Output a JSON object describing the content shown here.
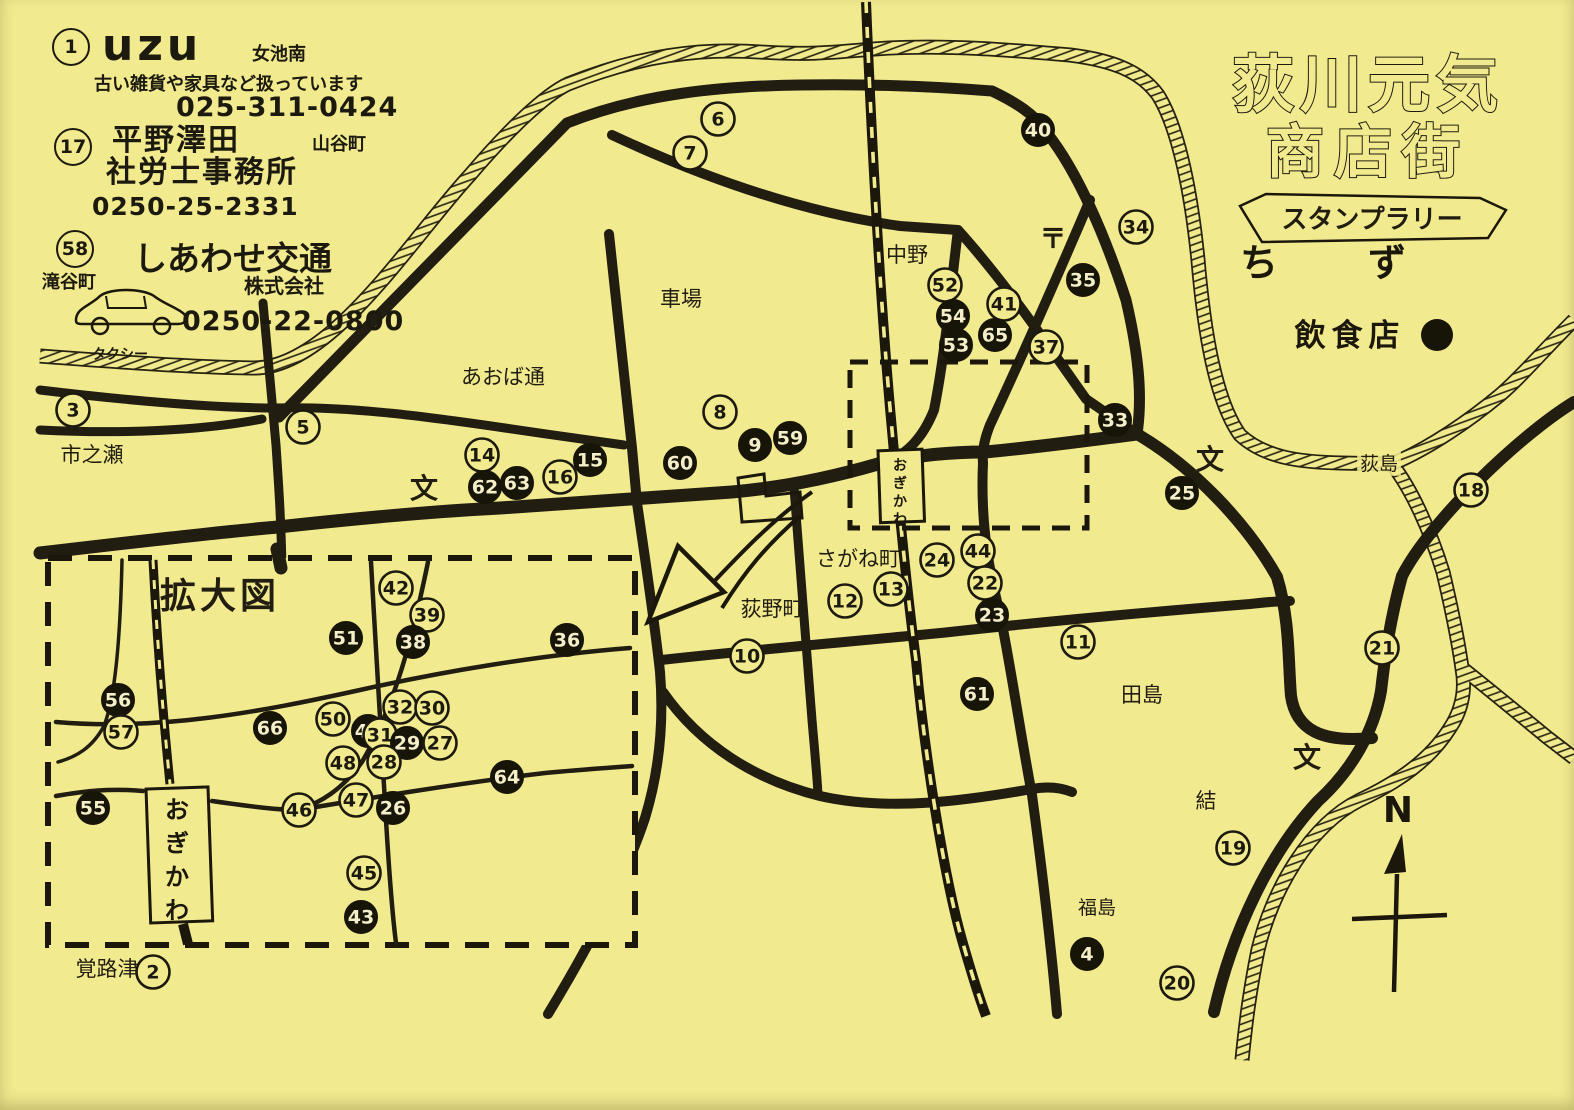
{
  "header": {
    "title_line1": "荻川元気",
    "title_line2": "商店街",
    "banner": "スタンプラリー",
    "subtitle": "ちず",
    "legend_label": "飲食店"
  },
  "ads": [
    {
      "number": "1",
      "name": "uzu",
      "area": "女池南",
      "desc": "古い雑貨や家具など扱っています",
      "phone": "025-311-0424"
    },
    {
      "number": "17",
      "line1": "平野澤田",
      "area": "山谷町",
      "line2": "社労士事務所",
      "phone": "0250-25-2331"
    },
    {
      "number": "58",
      "area": "滝谷町",
      "name": "しあわせ交通",
      "sub": "株式会社",
      "vehicle_label": "タクシー",
      "phone": "0250-22-0800"
    }
  ],
  "map": {
    "inset_title": "拡大図",
    "compass_label": "N",
    "station_signs": [
      {
        "text": "おぎかわ",
        "x": 900,
        "y": 450,
        "w": 44,
        "h": 72,
        "fs": 14
      },
      {
        "text": "おぎかわ",
        "x": 177,
        "y": 788,
        "w": 62,
        "h": 134,
        "fs": 24
      }
    ],
    "labels": [
      {
        "text": "市之瀬",
        "x": 92,
        "y": 462,
        "fs": 21
      },
      {
        "text": "あおば通",
        "x": 503,
        "y": 384,
        "fs": 21
      },
      {
        "text": "車場",
        "x": 681,
        "y": 306,
        "fs": 21
      },
      {
        "text": "中野",
        "x": 907,
        "y": 262,
        "fs": 21
      },
      {
        "text": "〒",
        "x": 1053,
        "y": 248,
        "fs": 27,
        "bold": true
      },
      {
        "text": "荻島",
        "x": 1379,
        "y": 470,
        "fs": 19,
        "bg": true
      },
      {
        "text": "文",
        "x": 424,
        "y": 498,
        "fs": 28,
        "bold": true
      },
      {
        "text": "文",
        "x": 1210,
        "y": 469,
        "fs": 28,
        "bold": true
      },
      {
        "text": "文",
        "x": 1307,
        "y": 767,
        "fs": 28,
        "bold": true
      },
      {
        "text": "さがね町",
        "x": 858,
        "y": 566,
        "fs": 21
      },
      {
        "text": "荻野町",
        "x": 772,
        "y": 616,
        "fs": 21
      },
      {
        "text": "田島",
        "x": 1142,
        "y": 702,
        "fs": 21
      },
      {
        "text": "結",
        "x": 1206,
        "y": 808,
        "fs": 21
      },
      {
        "text": "福島",
        "x": 1097,
        "y": 914,
        "fs": 19
      },
      {
        "text": "覚路津",
        "x": 107,
        "y": 976,
        "fs": 21
      }
    ],
    "markers": [
      {
        "n": 3,
        "x": 73,
        "y": 410,
        "filled": false
      },
      {
        "n": 5,
        "x": 303,
        "y": 427,
        "filled": false
      },
      {
        "n": 6,
        "x": 718,
        "y": 119,
        "filled": false
      },
      {
        "n": 7,
        "x": 690,
        "y": 153,
        "filled": false
      },
      {
        "n": 8,
        "x": 720,
        "y": 412,
        "filled": false
      },
      {
        "n": 9,
        "x": 755,
        "y": 445,
        "filled": true
      },
      {
        "n": 59,
        "x": 790,
        "y": 438,
        "filled": true
      },
      {
        "n": 60,
        "x": 680,
        "y": 463,
        "filled": true
      },
      {
        "n": 15,
        "x": 590,
        "y": 460,
        "filled": true
      },
      {
        "n": 16,
        "x": 560,
        "y": 477,
        "filled": false
      },
      {
        "n": 14,
        "x": 482,
        "y": 455,
        "filled": false
      },
      {
        "n": 62,
        "x": 485,
        "y": 487,
        "filled": true
      },
      {
        "n": 63,
        "x": 517,
        "y": 483,
        "filled": true
      },
      {
        "n": 40,
        "x": 1038,
        "y": 130,
        "filled": true
      },
      {
        "n": 34,
        "x": 1136,
        "y": 227,
        "filled": false
      },
      {
        "n": 35,
        "x": 1083,
        "y": 280,
        "filled": true
      },
      {
        "n": 52,
        "x": 945,
        "y": 285,
        "filled": false
      },
      {
        "n": 54,
        "x": 953,
        "y": 316,
        "filled": true
      },
      {
        "n": 53,
        "x": 956,
        "y": 345,
        "filled": true
      },
      {
        "n": 41,
        "x": 1004,
        "y": 304,
        "filled": false
      },
      {
        "n": 65,
        "x": 995,
        "y": 335,
        "filled": true
      },
      {
        "n": 37,
        "x": 1046,
        "y": 347,
        "filled": false
      },
      {
        "n": 33,
        "x": 1115,
        "y": 420,
        "filled": true
      },
      {
        "n": 25,
        "x": 1182,
        "y": 493,
        "filled": true
      },
      {
        "n": 18,
        "x": 1471,
        "y": 490,
        "filled": false
      },
      {
        "n": 24,
        "x": 937,
        "y": 560,
        "filled": false
      },
      {
        "n": 44,
        "x": 978,
        "y": 551,
        "filled": false
      },
      {
        "n": 22,
        "x": 985,
        "y": 583,
        "filled": false
      },
      {
        "n": 23,
        "x": 992,
        "y": 615,
        "filled": true
      },
      {
        "n": 12,
        "x": 845,
        "y": 601,
        "filled": false
      },
      {
        "n": 13,
        "x": 891,
        "y": 589,
        "filled": false
      },
      {
        "n": 10,
        "x": 747,
        "y": 656,
        "filled": false
      },
      {
        "n": 11,
        "x": 1078,
        "y": 642,
        "filled": false
      },
      {
        "n": 61,
        "x": 977,
        "y": 694,
        "filled": true
      },
      {
        "n": 21,
        "x": 1382,
        "y": 648,
        "filled": false
      },
      {
        "n": 19,
        "x": 1233,
        "y": 848,
        "filled": false
      },
      {
        "n": 4,
        "x": 1087,
        "y": 954,
        "filled": true
      },
      {
        "n": 20,
        "x": 1177,
        "y": 983,
        "filled": false
      },
      {
        "n": 2,
        "x": 153,
        "y": 972,
        "filled": false
      }
    ],
    "inset_markers": [
      {
        "n": 42,
        "x": 396,
        "y": 588,
        "filled": false
      },
      {
        "n": 39,
        "x": 427,
        "y": 615,
        "filled": false
      },
      {
        "n": 51,
        "x": 346,
        "y": 638,
        "filled": true
      },
      {
        "n": 38,
        "x": 413,
        "y": 642,
        "filled": true
      },
      {
        "n": 36,
        "x": 567,
        "y": 640,
        "filled": true
      },
      {
        "n": 56,
        "x": 118,
        "y": 700,
        "filled": true
      },
      {
        "n": 57,
        "x": 121,
        "y": 732,
        "filled": false
      },
      {
        "n": 66,
        "x": 270,
        "y": 728,
        "filled": true
      },
      {
        "n": 50,
        "x": 333,
        "y": 719,
        "filled": false
      },
      {
        "n": 49,
        "x": 368,
        "y": 731,
        "filled": true
      },
      {
        "n": 32,
        "x": 400,
        "y": 707,
        "filled": false
      },
      {
        "n": 30,
        "x": 432,
        "y": 708,
        "filled": false
      },
      {
        "n": 31,
        "x": 380,
        "y": 735,
        "filled": false
      },
      {
        "n": 29,
        "x": 407,
        "y": 743,
        "filled": true
      },
      {
        "n": 27,
        "x": 440,
        "y": 743,
        "filled": false
      },
      {
        "n": 48,
        "x": 343,
        "y": 763,
        "filled": false
      },
      {
        "n": 28,
        "x": 384,
        "y": 762,
        "filled": false
      },
      {
        "n": 64,
        "x": 507,
        "y": 777,
        "filled": true
      },
      {
        "n": 55,
        "x": 93,
        "y": 808,
        "filled": true
      },
      {
        "n": 46,
        "x": 299,
        "y": 810,
        "filled": false
      },
      {
        "n": 47,
        "x": 356,
        "y": 800,
        "filled": false
      },
      {
        "n": 26,
        "x": 393,
        "y": 808,
        "filled": true
      },
      {
        "n": 45,
        "x": 364,
        "y": 873,
        "filled": false
      },
      {
        "n": 43,
        "x": 361,
        "y": 917,
        "filled": true
      }
    ]
  }
}
